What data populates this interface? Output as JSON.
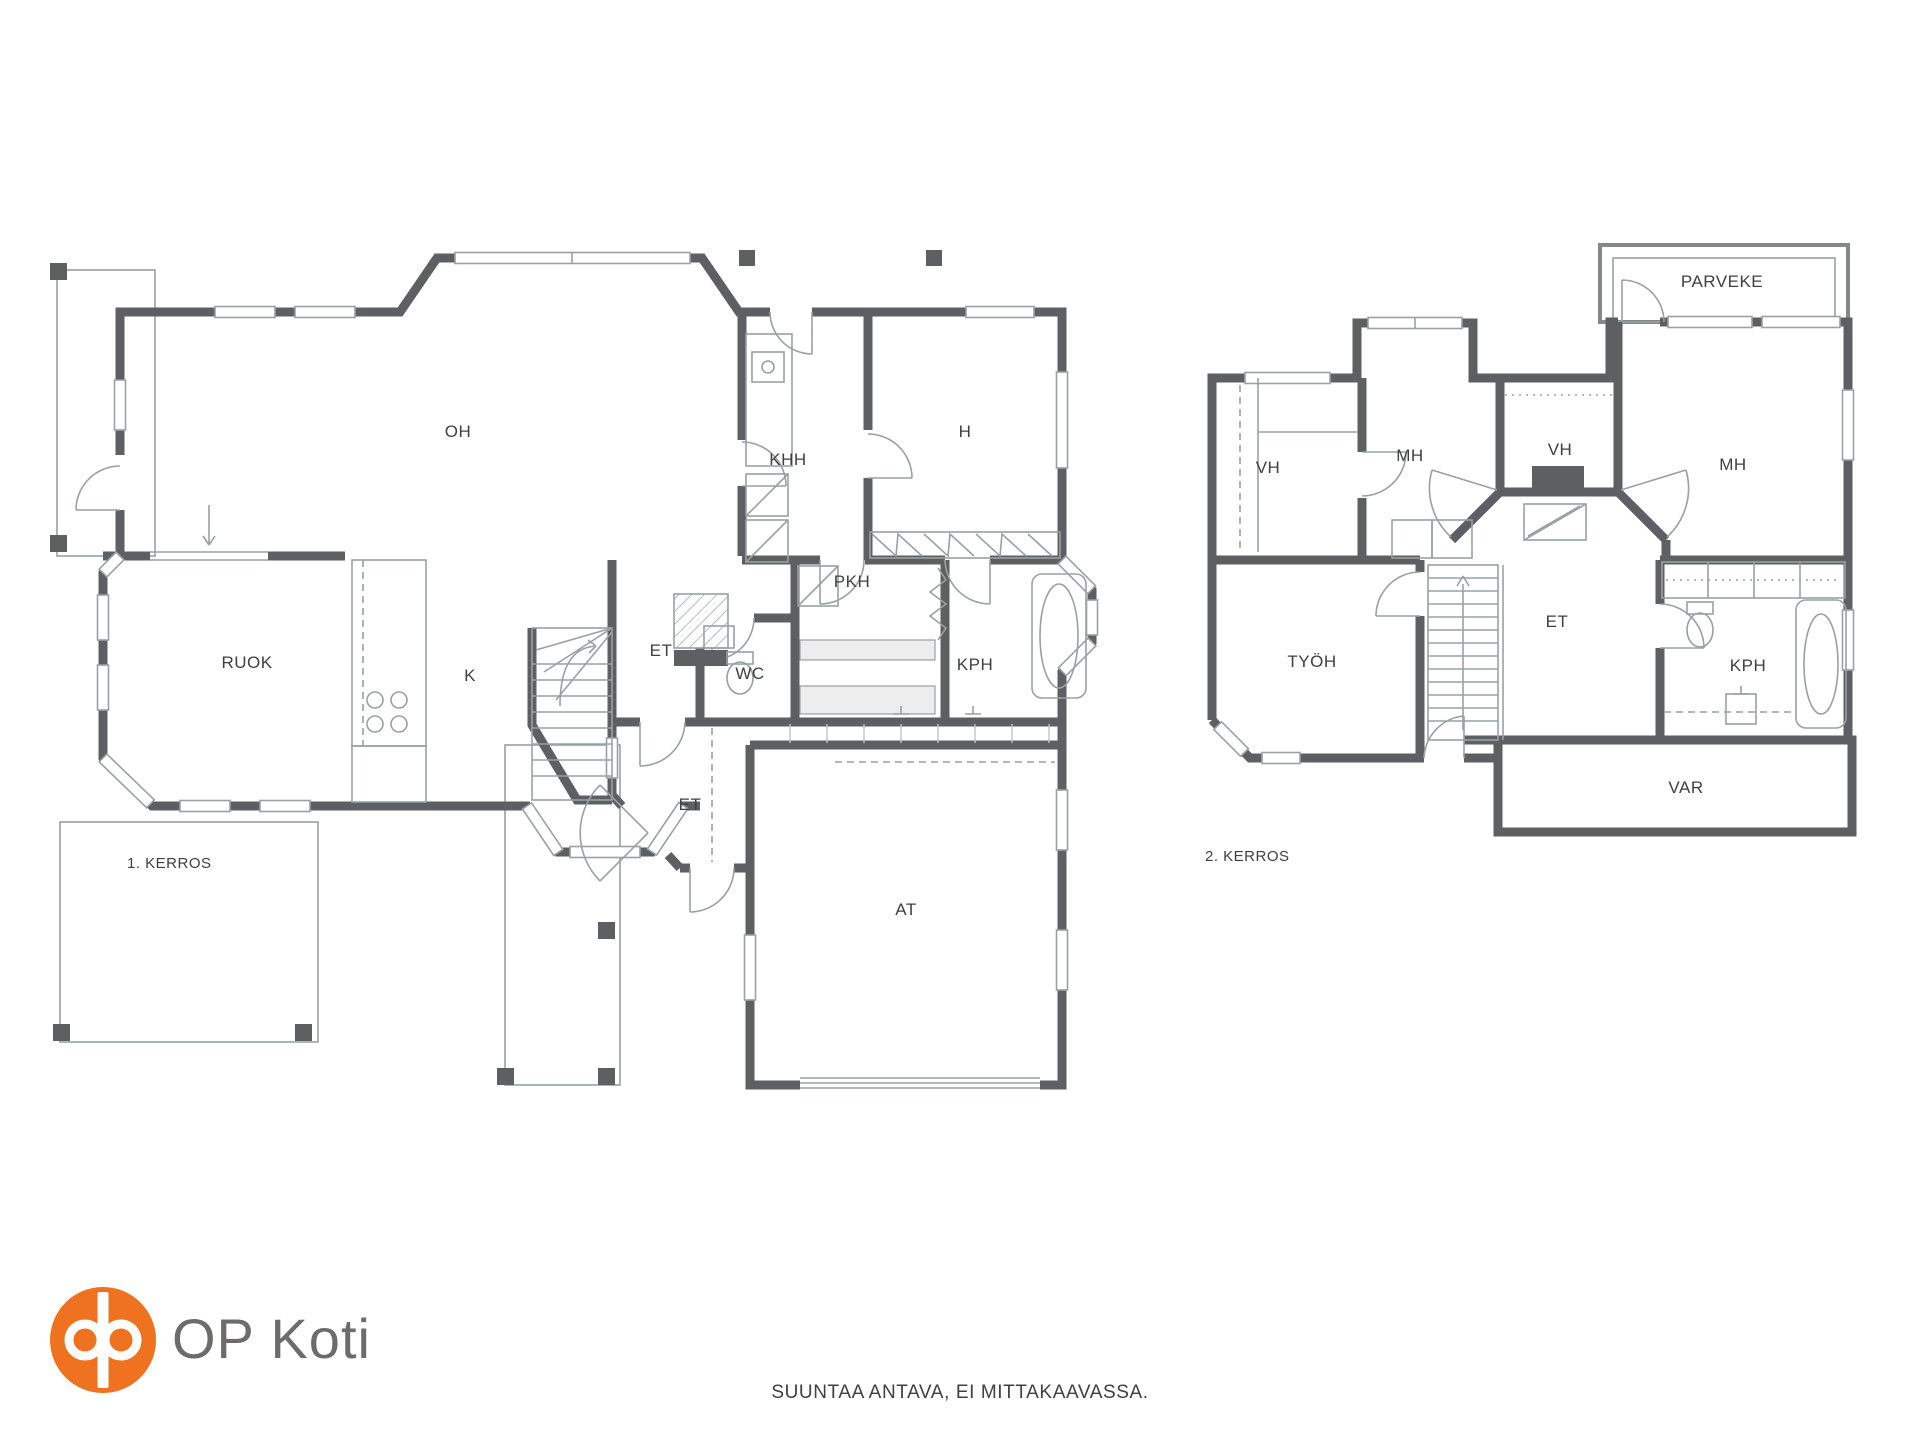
{
  "colors": {
    "wall": "#5d5f62",
    "thin_line": "#9aa0a3",
    "accent_orange": "#ee7220",
    "text": "#3f4040",
    "logo_text": "#6d6c6b"
  },
  "plan1": {
    "floor_label": "1. KERROS",
    "rooms": [
      {
        "label": "OH"
      },
      {
        "label": "KHH"
      },
      {
        "label": "H"
      },
      {
        "label": "PKH"
      },
      {
        "label": "RUOK"
      },
      {
        "label": "K"
      },
      {
        "label": "ET"
      },
      {
        "label": "WC"
      },
      {
        "label": "KPH"
      },
      {
        "label": "ET"
      },
      {
        "label": "AT"
      }
    ]
  },
  "plan2": {
    "floor_label": "2. KERROS",
    "rooms": [
      {
        "label": "PARVEKE"
      },
      {
        "label": "VH"
      },
      {
        "label": "MH"
      },
      {
        "label": "VH"
      },
      {
        "label": "MH"
      },
      {
        "label": "TYÖH"
      },
      {
        "label": "ET"
      },
      {
        "label": "KPH"
      },
      {
        "label": "VAR"
      }
    ]
  },
  "footer": {
    "logo_text": "OP Koti",
    "disclaimer": "SUUNTAA ANTAVA, EI MITTAKAAVASSA."
  }
}
